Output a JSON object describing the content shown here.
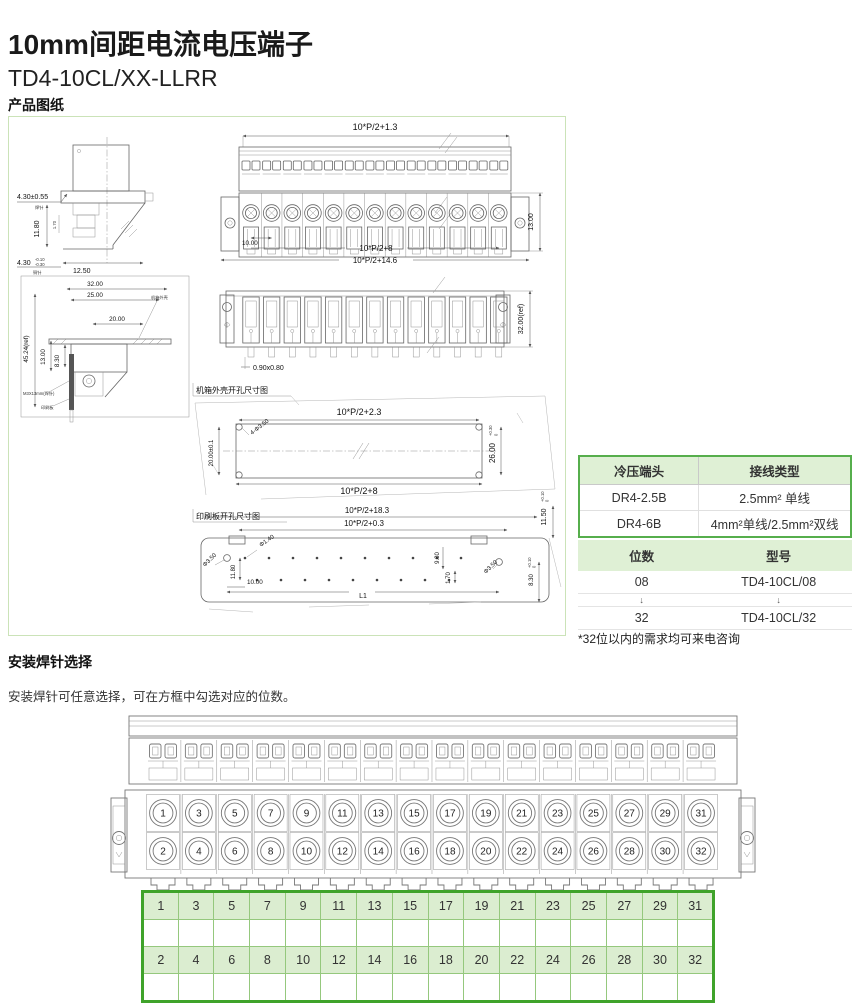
{
  "page": {
    "title": "10mm间距电流电压端子",
    "subtitle": "TD4-10CL/XX-LLRR",
    "drawings_section": "产品图纸",
    "pins_section": "安装焊针选择",
    "pins_note": "安装焊针可任意选择，可在方框中勾选对应的位数。"
  },
  "crimp_table": {
    "headers": [
      "冷压端头",
      "接线类型"
    ],
    "rows": [
      [
        "DR4-2.5B",
        "2.5mm² 单线"
      ],
      [
        "DR4-6B",
        "4mm²单线/2.5mm²双线"
      ]
    ]
  },
  "model_table": {
    "headers": [
      "位数",
      "型号"
    ],
    "rows": [
      [
        "08",
        "TD4-10CL/08"
      ],
      [
        "↓",
        "↓"
      ],
      [
        "32",
        "TD4-10CL/32"
      ]
    ],
    "footnote": "*32位以内的需求均可来电咨询"
  },
  "selector": {
    "row_odd": [
      "1",
      "3",
      "5",
      "7",
      "9",
      "11",
      "13",
      "15",
      "17",
      "19",
      "21",
      "23",
      "25",
      "27",
      "29",
      "31"
    ],
    "row_even": [
      "2",
      "4",
      "6",
      "8",
      "10",
      "12",
      "14",
      "16",
      "18",
      "20",
      "22",
      "24",
      "26",
      "28",
      "30",
      "32"
    ]
  },
  "dims": {
    "front_width": "10*P/2+1.3",
    "front_height": "13.00",
    "front_pitch": "10.00",
    "front_inner": "10*P/2+8",
    "front_total": "10*P/2+14.6",
    "side_a": "4.30±0.55",
    "side_a_note": "焊针",
    "side_b": "11.80",
    "side_c": "1.70",
    "side_d": "4.30",
    "side_d_tol_top": "-0.10",
    "side_d_tol_bot": "-0.30",
    "side_d_note": "铜针",
    "side_e": "12.50",
    "mount_32": "32.00",
    "mount_25": "25.00",
    "mount_20": "20.00",
    "mount_4524": "45.24(ref)",
    "mount_13": "13.00",
    "mount_83": "8.30",
    "mount_case": "机箱外壳",
    "mount_pin": "M3X13mm(焊针)",
    "mount_pcb": "印刷板",
    "back_slot": "0.90x0.80",
    "back_height": "32.00(ref)",
    "case_title": "机箱外壳开孔尺寸图",
    "case_top": "10*P/2+2.3",
    "case_bottom": "10*P/2+8",
    "case_left": "20.00±0.1",
    "case_right": "26.00",
    "case_right_tol_top": "+0.30",
    "case_right_tol_bot": "0",
    "case_holes": "4-Φ3.50",
    "pcb_title": "印刷板开孔尺寸图",
    "pcb_top": "10*P/2+18.3",
    "pcb_top2": "10*P/2+0.3",
    "pcb_1150": "11.50",
    "pcb_830": "8.30",
    "tol_top": "+0.10",
    "tol_bot": "0",
    "pcb_d140": "Φ1.40",
    "pcb_d350l": "Φ3.50",
    "pcb_d350r": "Φ3.50",
    "pcb_1180": "11.80",
    "pcb_1000": "10.00",
    "pcb_980": "9.80",
    "pcb_170": "1.70",
    "pcb_L1": "L1"
  },
  "colors": {
    "accent_green": "#3FA32A",
    "table_border_green": "#56AE4C",
    "header_fill_green": "#DFF0D5",
    "cell_fill_green": "#DBEDD0",
    "panel_border_green": "#CBE3B8",
    "drawing_line": "#666666"
  }
}
